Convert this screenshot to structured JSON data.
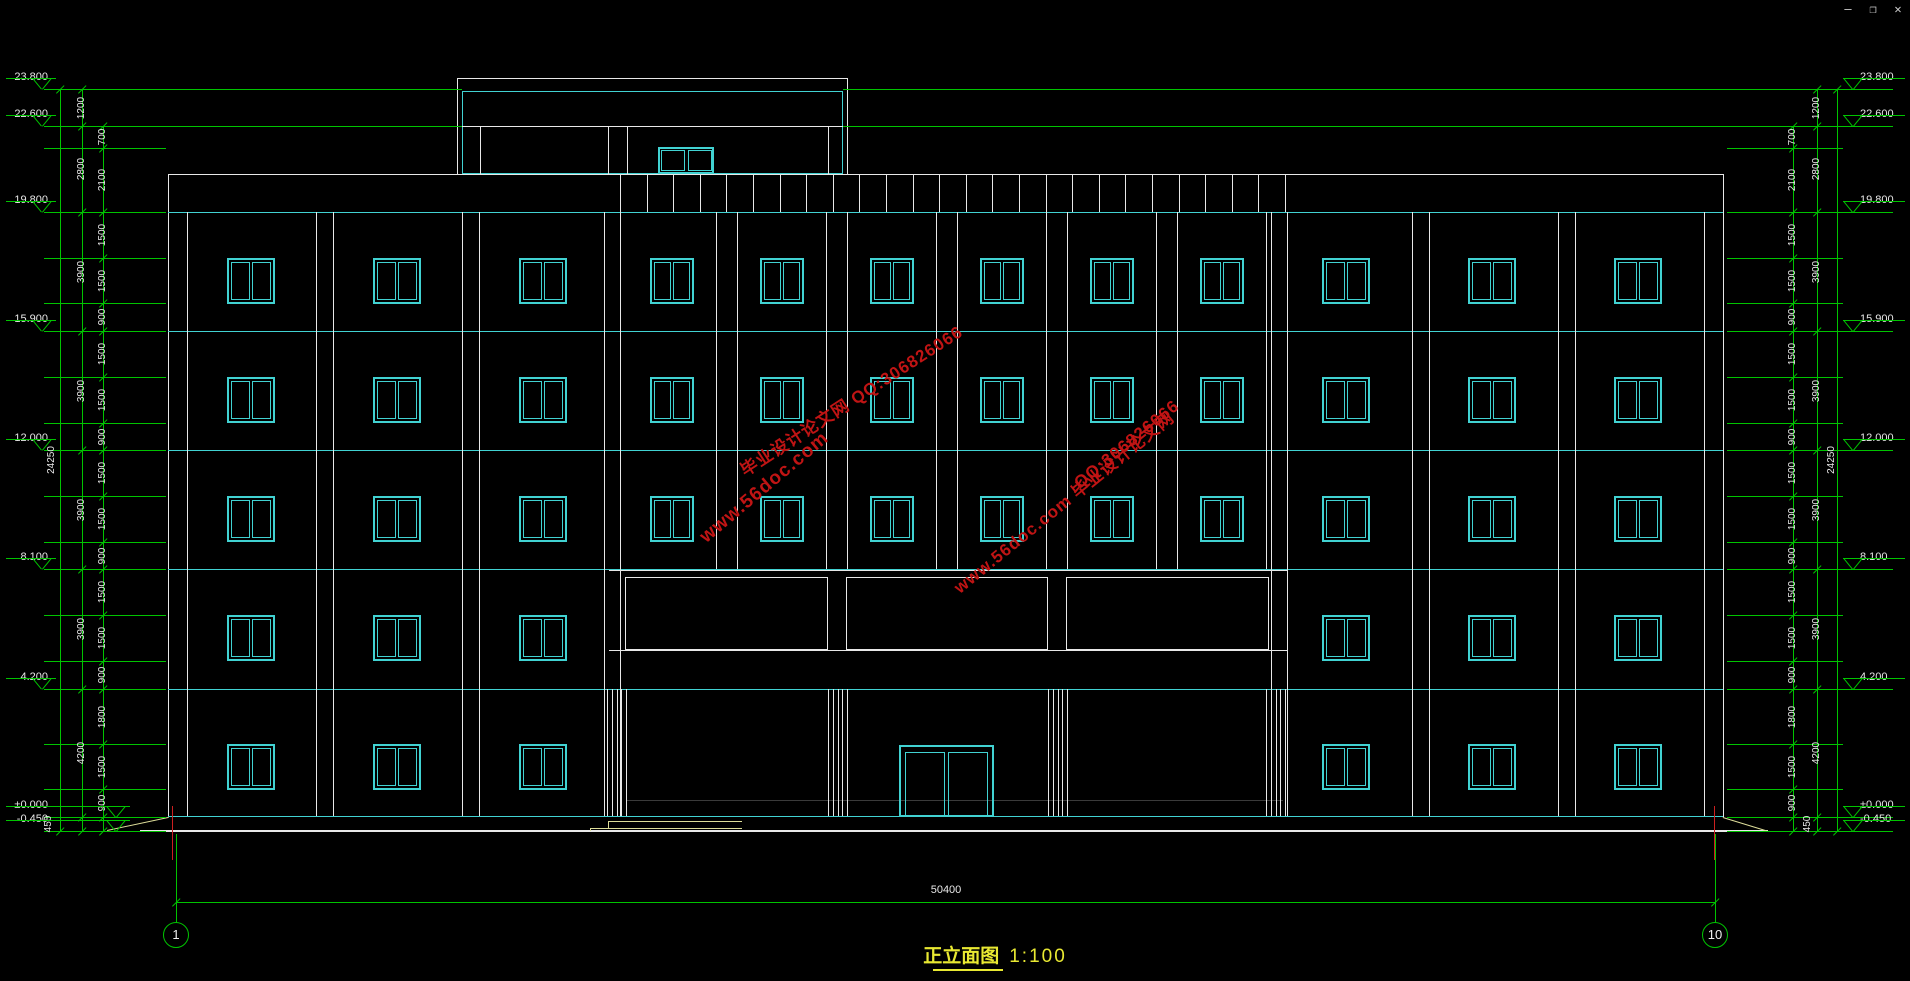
{
  "window_controls": {
    "minimize": "—",
    "restore": "❐",
    "close": "✕"
  },
  "title_block": {
    "name": "正立面图",
    "scale": "1:100"
  },
  "axis_markers": {
    "left": "1",
    "right": "10"
  },
  "dimensions": {
    "overall_width": "50400",
    "overall_height": "24250",
    "story_chain": [
      1200,
      2800,
      3900,
      3900,
      3900,
      3900,
      4200,
      450
    ],
    "fine_chain": [
      700,
      2100,
      1500,
      1500,
      900,
      1500,
      1500,
      900,
      1500,
      1500,
      900,
      1500,
      1500,
      900,
      1800,
      1500,
      900,
      450
    ]
  },
  "levels": [
    {
      "label": "23.800",
      "value": 23.8
    },
    {
      "label": "22.600",
      "value": 22.6
    },
    {
      "label": "19.800",
      "value": 19.8
    },
    {
      "label": "15.900",
      "value": 15.9
    },
    {
      "label": "12.000",
      "value": 12.0
    },
    {
      "label": "8.100",
      "value": 8.1
    },
    {
      "label": "4.200",
      "value": 4.2
    },
    {
      "label": "±0.000",
      "value": 0
    },
    {
      "label": "-0.450",
      "value": -0.45
    }
  ],
  "watermarks": [
    {
      "text": "毕业设计论文网 QQ:306826066"
    },
    {
      "text": "www.56doc.com"
    },
    {
      "text": "QQ:306826066"
    },
    {
      "text": "www.56doc.com 毕业设计论文网"
    }
  ],
  "colors": {
    "background": "#000000",
    "line_white": "#e8e8e8",
    "line_cyan": "#41d2d2",
    "dim_green": "#00c400",
    "title_yellow": "#e8e832",
    "watermark_red": "#c01414",
    "axis_red": "#cc2020",
    "step_yellow": "#dede9a",
    "gray_line": "#3a3a3a"
  }
}
